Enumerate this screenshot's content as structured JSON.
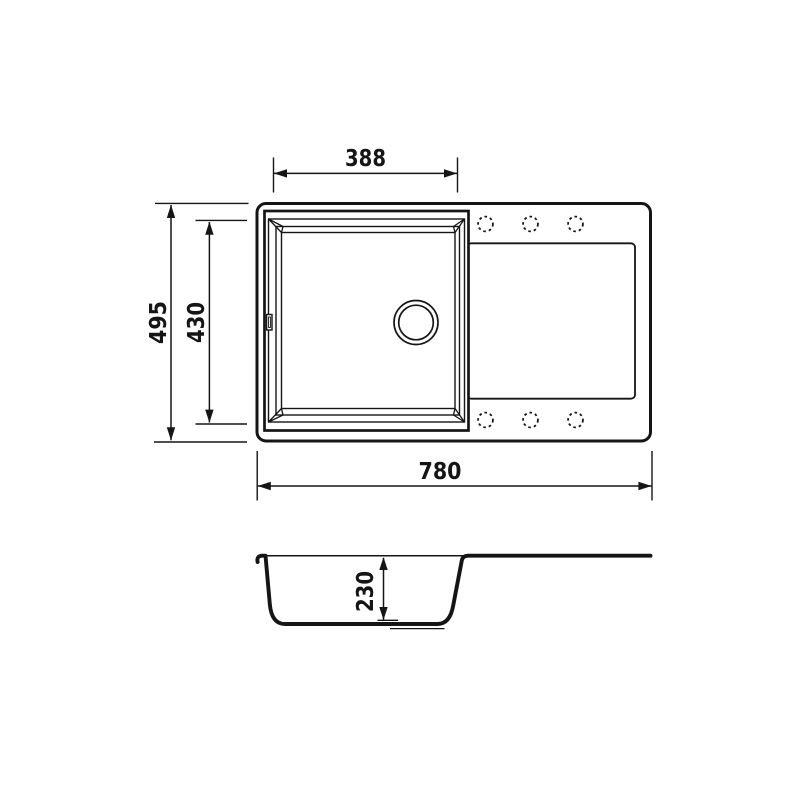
{
  "colors": {
    "background": "#ffffff",
    "line": "#151515"
  },
  "top_view": {
    "dimensions": {
      "bowl_width": "388",
      "overall_depth": "495",
      "bowl_depth": "430",
      "overall_width": "780"
    },
    "tap_hole_count": "6"
  },
  "side_view": {
    "dimensions": {
      "bowl_height": "230"
    }
  }
}
